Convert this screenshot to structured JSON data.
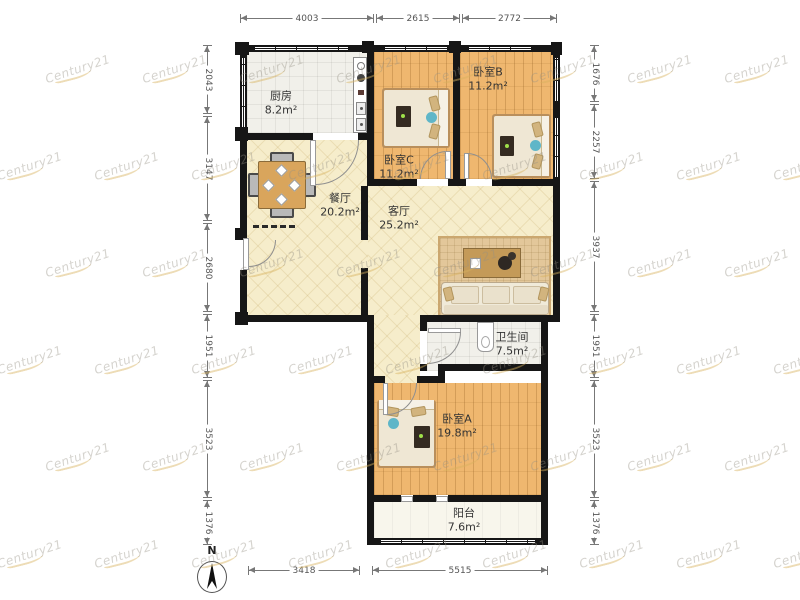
{
  "rooms": {
    "kitchen": {
      "name": "厨房",
      "area": "8.2m²"
    },
    "bedroom_b": {
      "name": "卧室B",
      "area": "11.2m²"
    },
    "bedroom_c": {
      "name": "卧室C",
      "area": "11.2m²"
    },
    "dining": {
      "name": "餐厅",
      "area": "20.2m²"
    },
    "living": {
      "name": "客厅",
      "area": "25.2m²"
    },
    "bathroom": {
      "name": "卫生间",
      "area": "7.5m²"
    },
    "bedroom_a": {
      "name": "卧室A",
      "area": "19.8m²"
    },
    "balcony": {
      "name": "阳台",
      "area": "7.6m²"
    }
  },
  "dimensions": {
    "top": [
      "4003",
      "2615",
      "2772"
    ],
    "bottom": [
      "3418",
      "5515"
    ],
    "left": [
      "2043",
      "3147",
      "2680",
      "1951",
      "3523",
      "1376"
    ],
    "right": [
      "1676",
      "2257",
      "3937",
      "1951",
      "3523",
      "1376"
    ]
  },
  "compass": {
    "label": "N"
  },
  "watermark": {
    "text": "Century21"
  },
  "colors": {
    "wall": "#161616",
    "wood_floor": "#EFB76F",
    "tile_floor": "#F6EDCB",
    "accent_teal": "#5FB6C8",
    "watermark_gold": "#D6B25E"
  }
}
